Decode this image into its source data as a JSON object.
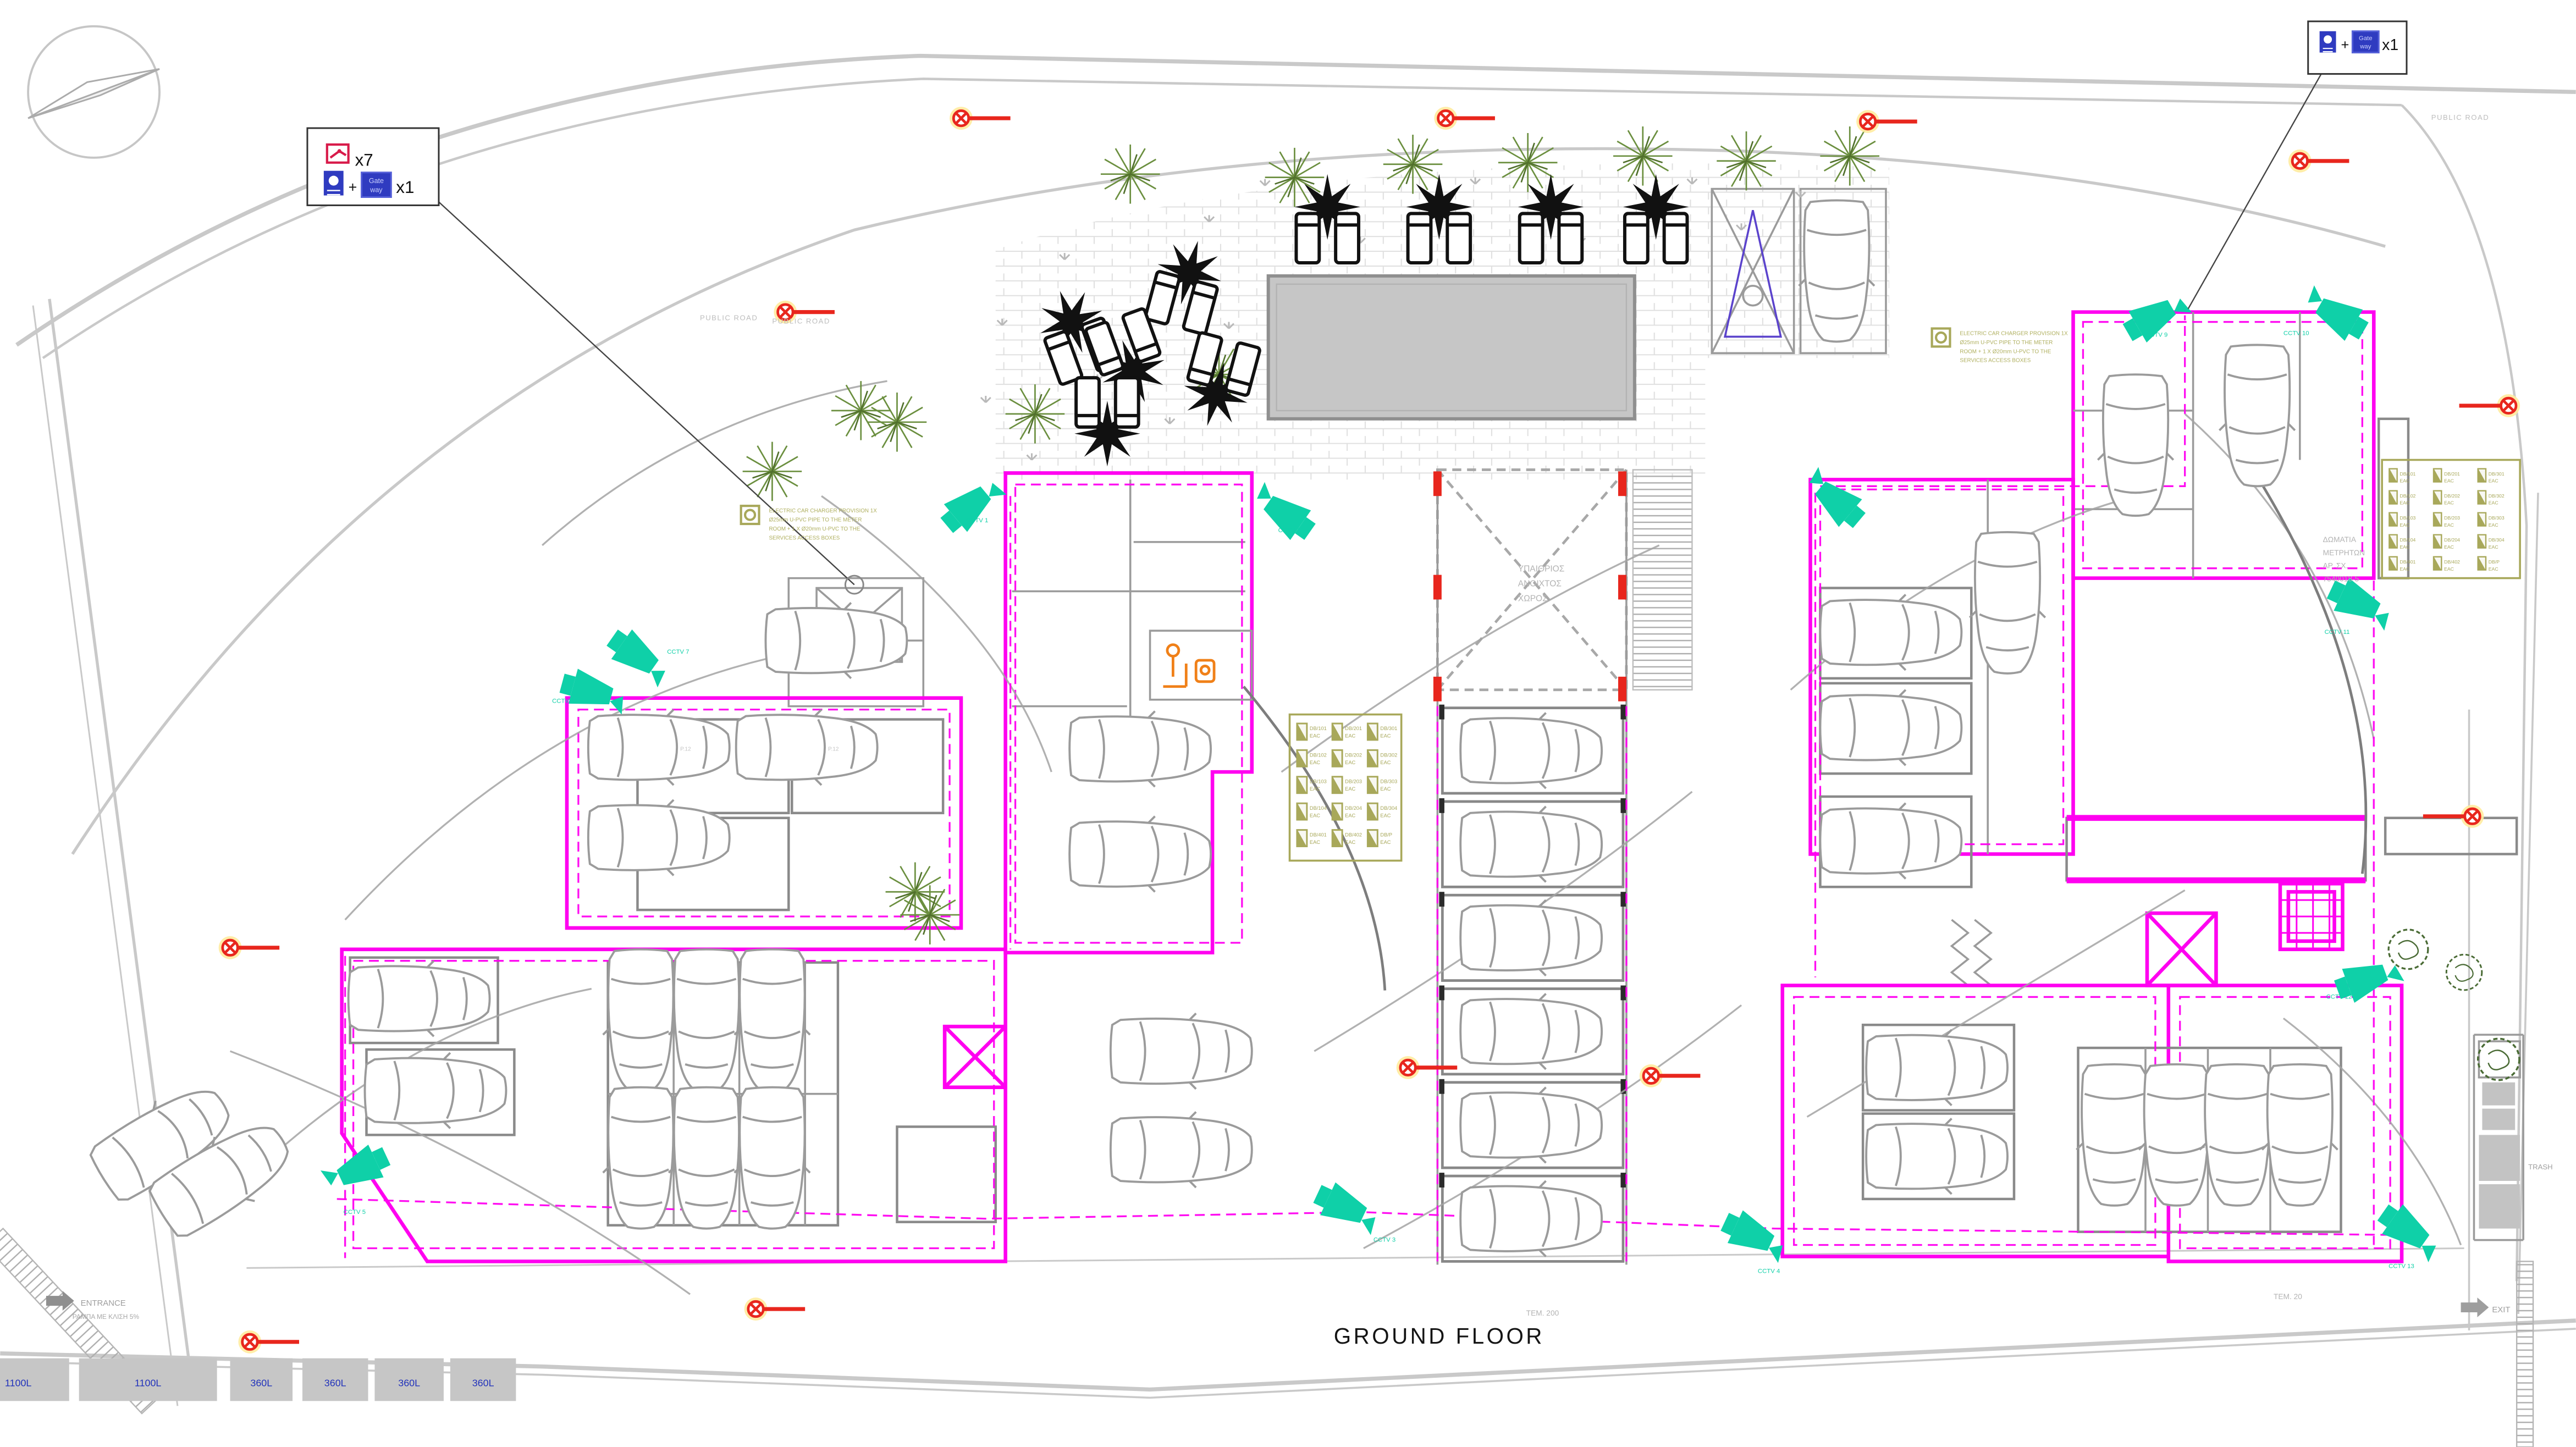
{
  "drawing": {
    "title": "GROUND FLOOR",
    "count_note_center": "ΤΕΜ. 200",
    "count_note_right": "ΤΕΜ. 20"
  },
  "legend_left": {
    "camera_icon": "cctv-plan-camera-icon",
    "camera_count": "x7",
    "plus": "+",
    "recorder_icon": "nvr-recorder-icon",
    "gateway_line1": "Gate",
    "gateway_line2": "way",
    "set_count": "x1"
  },
  "legend_right": {
    "plus": "+",
    "gateway_line1": "Gate",
    "gateway_line2": "way",
    "set_count": "x1"
  },
  "roads": {
    "public_road": "PUBLIC ROAD"
  },
  "site": {
    "entrance": "ENTRANCE",
    "entrance_ramp": "ΡΑΜΠΑ ΜΕ ΚΛΙΣΗ 5%",
    "exit": "EXIT",
    "trash": "TRASH",
    "courtyard": [
      "ΥΠΑΙΘΡΙΟΣ",
      "ΑΝΟΙΧΤΟΣ",
      "ΧΩΡΟΣ"
    ],
    "meter_rooms": [
      "ΔΩΜΑΤΙΑ",
      "ΜΕΤΡΗΤΩΝ",
      "ΑΡ. ΣΧ.",
      "7540018-5"
    ]
  },
  "notes": {
    "ev_charger": [
      "ELECTRIC CAR CHARGER PROVISION 1X",
      "Ø25mm U-PVC PIPE TO THE METER",
      "ROOM + 1 X Ø20mm U-PVC TO THE",
      "SERVICES ACCESS BOXES"
    ]
  },
  "bins": [
    "1100L",
    "1100L",
    "360L",
    "360L",
    "360L",
    "360L"
  ],
  "db_panels": {
    "suffix": "EAC",
    "codes": [
      "DB/101",
      "DB/201",
      "DB/301",
      "DB/102",
      "DB/202",
      "DB/302",
      "DB/103",
      "DB/203",
      "DB/303",
      "DB/104",
      "DB/204",
      "DB/304",
      "DB/401",
      "DB/402",
      "DB/P"
    ]
  },
  "cctv": {
    "labels": [
      "CCTV 1",
      "CCTV 2",
      "CCTV 3",
      "CCTV 4",
      "CCTV 5",
      "CCTV 6",
      "CCTV 7",
      "CCTV 8",
      "CCTV 9",
      "CCTV 10",
      "CCTV 11",
      "CCTV 12",
      "CCTV 13"
    ]
  },
  "parking": {
    "labels": [
      "P.12",
      "P.12"
    ]
  },
  "colors": {
    "wall": "#ff00f0",
    "cctv": "#0fd0a8",
    "panel": "#a8a85a",
    "light": "#e8261d",
    "legend_blue": "#2f3bc0",
    "legend_red": "#d81b4a",
    "bin_text": "#2233bb"
  }
}
